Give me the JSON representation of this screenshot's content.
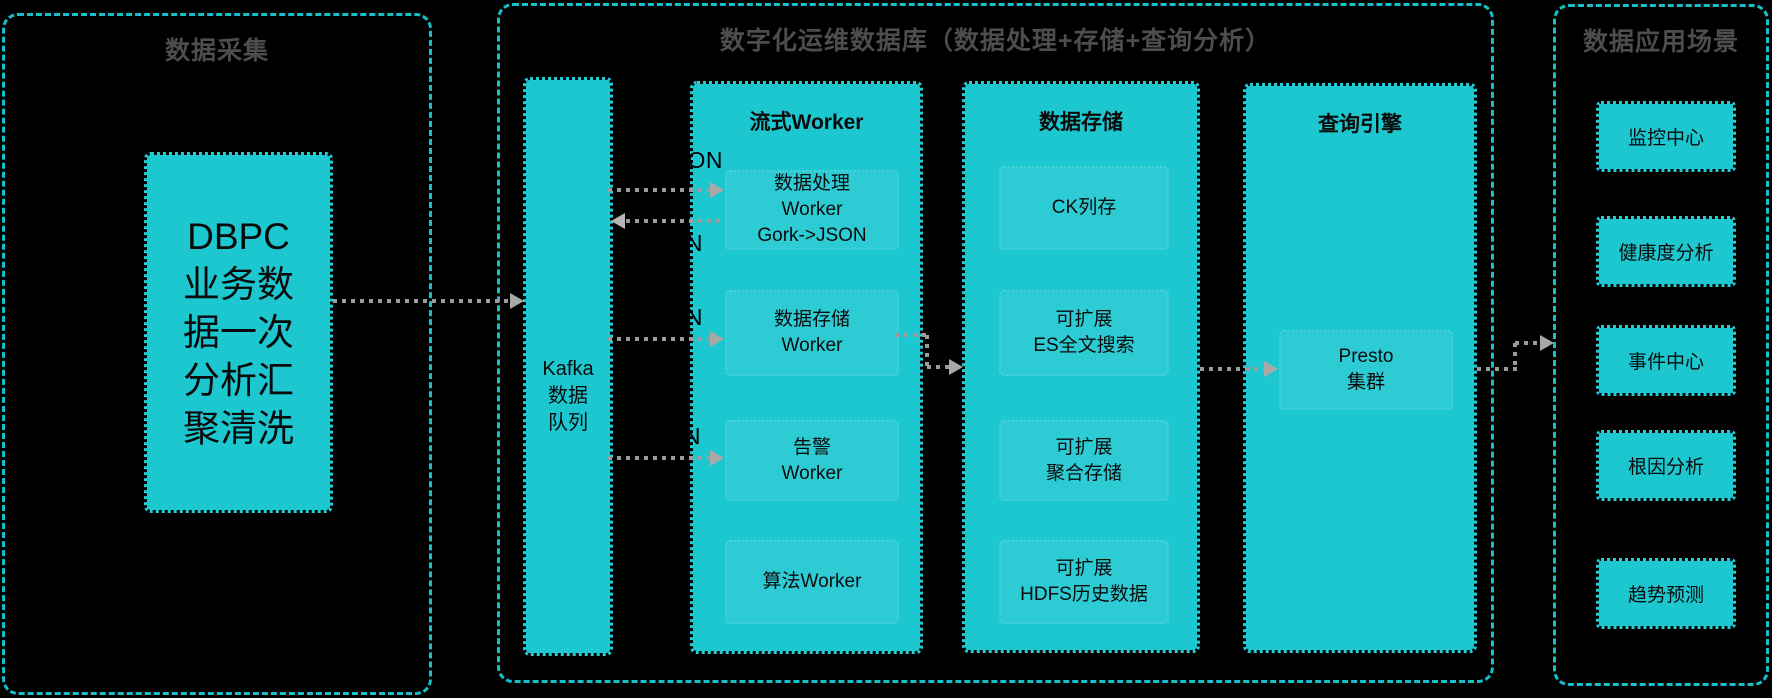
{
  "collection": {
    "title": "数据采集",
    "dbpc_lines": [
      "DBPC",
      "业务数",
      "据一次",
      "分析汇",
      "聚清洗"
    ]
  },
  "platform": {
    "title": "数字化运维数据库（数据处理+存储+查询分析）",
    "kafka_lines": [
      "Kafka",
      "数据",
      "队列"
    ],
    "stream": {
      "title": "流式Worker",
      "item1": [
        "数据处理",
        "Worker",
        "Gork->JSON"
      ],
      "item2": [
        "数据存储",
        "Worker"
      ],
      "item3": [
        "告警",
        "Worker"
      ],
      "item4": [
        "算法Worker"
      ]
    },
    "storage": {
      "title": "数据存储",
      "item1": [
        "CK列存"
      ],
      "item2": [
        "可扩展",
        "ES全文搜索"
      ],
      "item3": [
        "可扩展",
        "聚合存储"
      ],
      "item4": [
        "可扩展",
        "HDFS历史数据"
      ]
    },
    "query": {
      "title": "查询引擎",
      "item1": [
        "Presto",
        "集群"
      ]
    },
    "json_labels": [
      "JSON",
      "JSON",
      "JSON",
      "JSON"
    ]
  },
  "applications": {
    "title": "数据应用场景",
    "items": [
      "监控中心",
      "健康度分析",
      "事件中心",
      "根因分析",
      "趋势预测"
    ]
  },
  "colors": {
    "background": "#000000",
    "box_cyan": "#1cc7d0",
    "container_border": "#15c0ca",
    "title_gray": "#4d4d4d",
    "arrow_gray": "#9c9c9c",
    "text_dark": "#0a0a0a"
  }
}
